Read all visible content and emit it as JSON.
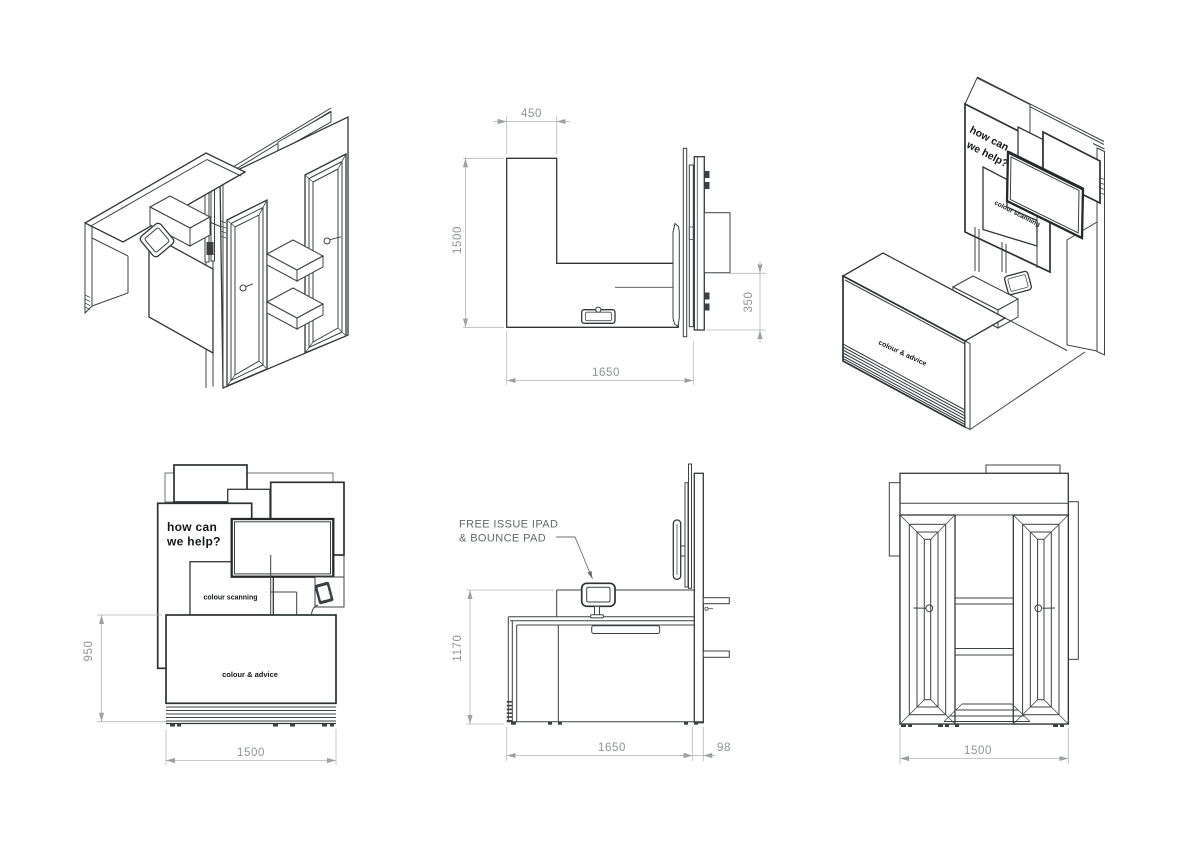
{
  "labels": {
    "headline1": "how can",
    "headline2": "we help?",
    "scanning": "colour scanning",
    "advice": "colour & advice"
  },
  "callout": {
    "line1": "FREE ISSUE IPAD",
    "line2": "& BOUNCE PAD"
  },
  "dims": {
    "plan": {
      "return_width": "450",
      "depth": "1500",
      "panel_offset": "350",
      "width": "1650"
    },
    "front": {
      "height": "950",
      "width": "1500"
    },
    "side": {
      "height": "1170",
      "width": "1650",
      "panel_depth": "98"
    },
    "rear": {
      "width": "1500"
    }
  },
  "colors": {
    "line": "#3c4043",
    "line_dark": "#26282a",
    "dim_line": "#b3b6b9",
    "dim_text": "#8f9396",
    "label_text": "#141618",
    "callout_text": "#63676b",
    "background": "#ffffff"
  }
}
